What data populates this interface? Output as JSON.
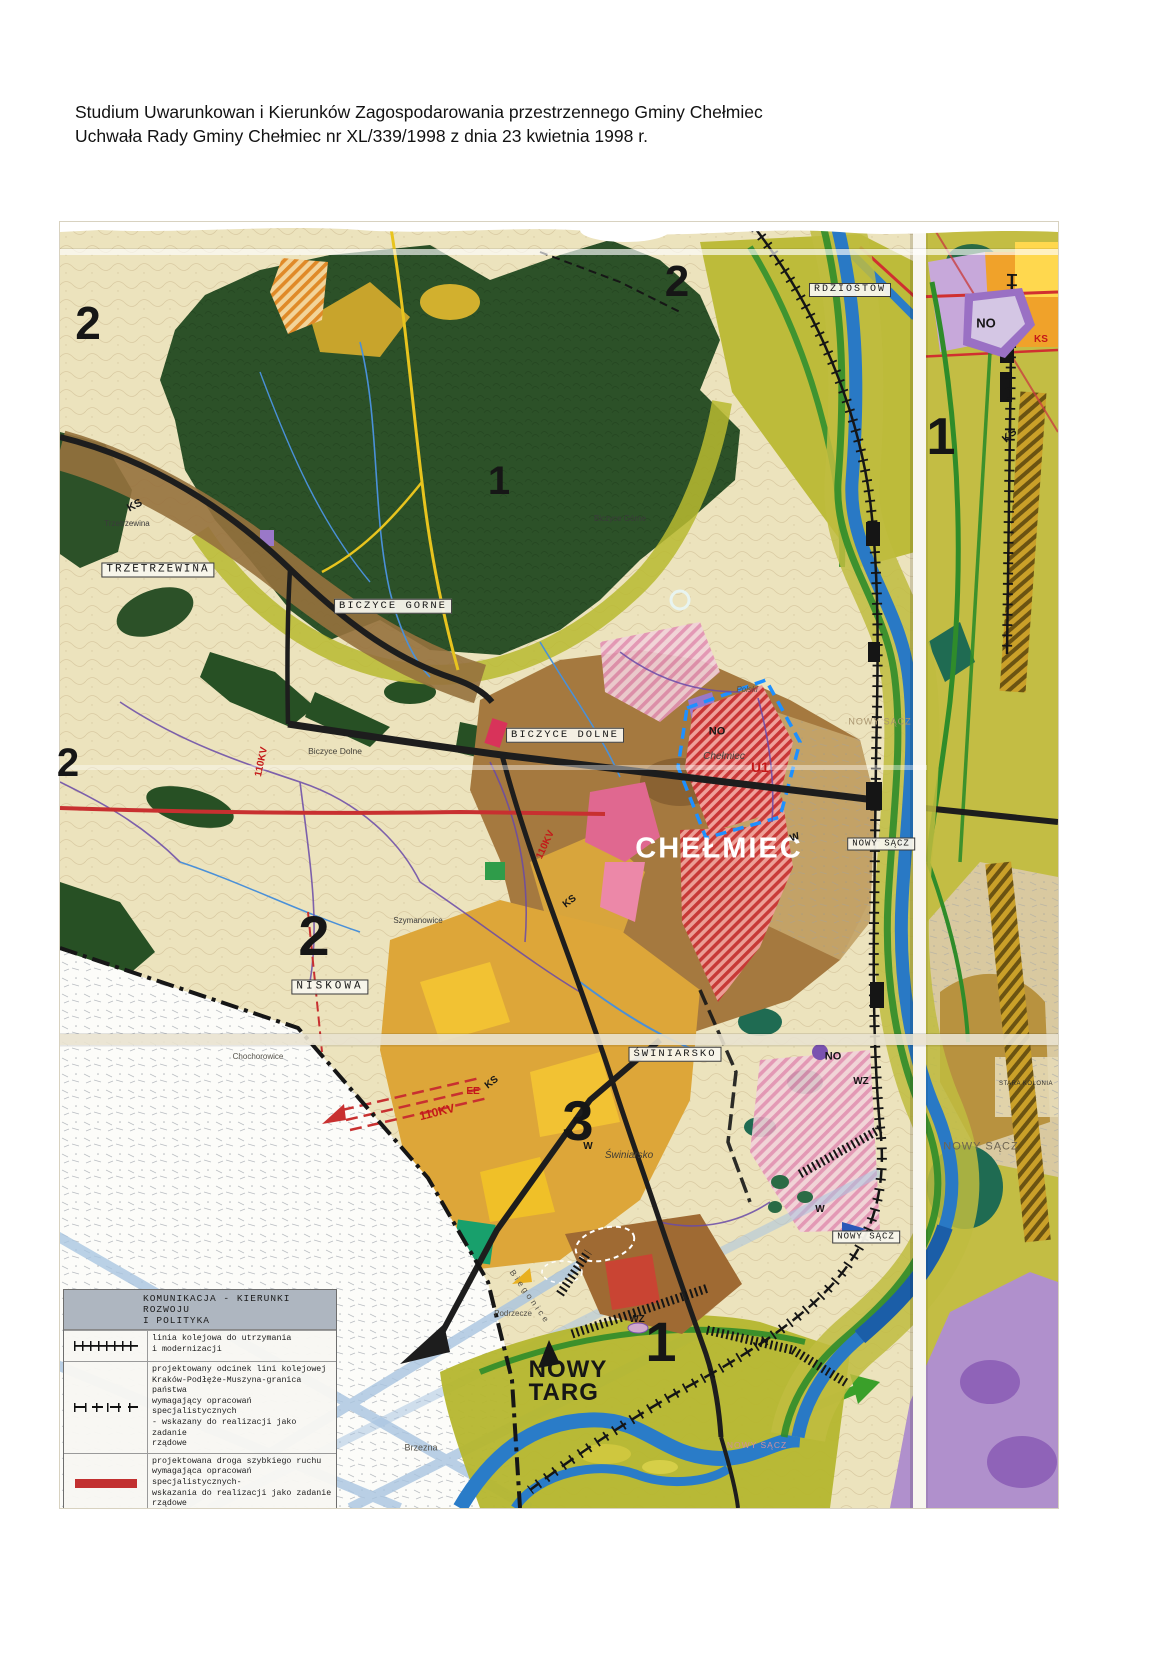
{
  "header": {
    "line1": "Studium Uwarunkowan i Kierunków Zagospodarowania przestrzennego Gminy Chełmiec",
    "line2": "Uchwała Rady Gminy Chełmiec nr XL/339/1998 z dnia 23 kwietnia 1998 r."
  },
  "legend": {
    "title_line1": "KOMUNIKACJA - KIERUNKI ROZWOJU",
    "title_line2": "I POLITYKA",
    "items": [
      {
        "name": "railway-existing",
        "text": "linia kolejowa do utrzymania\ni modernizacji"
      },
      {
        "name": "railway-projected",
        "text": "projektowany odcinek lini kolejowej\nKraków-Podłęże-Muszyna-granica państwa\nwymagający opracowań specjalistycznych\n- wskazany do realizacji jako zadanie\nrządowe"
      },
      {
        "name": "expressway-projected",
        "text": "projektowana droga szybkiego  ruchu\nwymagająca opracowań specjalistycznych-\nwskazania do realizacji jako zadanie\nrządowe"
      },
      {
        "name": "national-roads",
        "text": "drogi krajowe wymagające modernizacji"
      },
      {
        "name": "national-roads-projected",
        "text": "projektowane odcinki dróg krajowych\no funkcji regionalnej wymagające\nopracowań specjalistycznych - wskazane\ndo realizacji jako zadanie rządowe"
      }
    ]
  },
  "palette": {
    "forest_green": "#2c5128",
    "valley_olive": "#bdbb3a",
    "river_blue": "#2979c5",
    "urban_brown": "#a5793f",
    "zone_mustard": "#dda639",
    "accent_red": "#c41818",
    "purple_zone": "#9a70c4",
    "cream_base": "#ece3bd"
  },
  "map": {
    "labels": [
      {
        "id": "zone-2-top-left",
        "text": "2",
        "x": 88,
        "y": 323,
        "fs": 46,
        "fw": 700
      },
      {
        "id": "zone-2-top-center",
        "text": "2",
        "x": 677,
        "y": 282,
        "fs": 44,
        "fw": 700
      },
      {
        "id": "zone-1-forest",
        "text": "1",
        "x": 499,
        "y": 481,
        "fs": 40,
        "fw": 700
      },
      {
        "id": "zone-1-right-panel",
        "text": "1",
        "x": 941,
        "y": 437,
        "fs": 52,
        "fw": 700
      },
      {
        "id": "zone-2-left-edge",
        "text": "2",
        "x": 68,
        "y": 763,
        "fs": 40,
        "fw": 700
      },
      {
        "id": "zone-2-niskowa",
        "text": "2",
        "x": 314,
        "y": 936,
        "fs": 56,
        "fw": 700
      },
      {
        "id": "zone-3-swiniarsko",
        "text": "3",
        "x": 578,
        "y": 1121,
        "fs": 56,
        "fw": 700
      },
      {
        "id": "zone-1-bottom",
        "text": "1",
        "x": 661,
        "y": 1342,
        "fs": 56,
        "fw": 700
      },
      {
        "id": "label-rdziostow",
        "text": "RDZIOSTOW",
        "x": 850,
        "y": 290,
        "fs": 10,
        "ls": 2,
        "bg": 1,
        "ff": "mono"
      },
      {
        "id": "label-trzetrzewina-small",
        "text": "Trzetrzewina",
        "x": 127,
        "y": 524,
        "fs": 8,
        "color": "#3a3a3a"
      },
      {
        "id": "label-trzetrzewina",
        "text": "TRZETRZEWINA",
        "x": 158,
        "y": 570,
        "fs": 11,
        "ls": 2,
        "bg": 1,
        "ff": "mono"
      },
      {
        "id": "label-ks-northwest",
        "text": "KS",
        "x": 135,
        "y": 506,
        "fs": 11,
        "fw": 700,
        "rot": -28
      },
      {
        "id": "label-biczyce-gorne-small",
        "text": "Biczyce Górne",
        "x": 620,
        "y": 519,
        "fs": 8,
        "color": "#3a3a3a"
      },
      {
        "id": "label-biczyce-gorne",
        "text": "BICZYCE GORNE",
        "x": 393,
        "y": 606,
        "fs": 10.5,
        "ls": 2,
        "bg": 1,
        "ff": "mono"
      },
      {
        "id": "label-biczyce-dolne",
        "text": "BICZYCE DOLNE",
        "x": 565,
        "y": 735,
        "fs": 10.5,
        "ls": 2,
        "bg": 1,
        "ff": "mono"
      },
      {
        "id": "label-biczyce-dolne-small",
        "text": "Biczyce Dolne",
        "x": 335,
        "y": 751,
        "fs": 8.5,
        "color": "#44423a"
      },
      {
        "id": "label-110kv-west",
        "text": "110KV",
        "x": 262,
        "y": 762,
        "fs": 10,
        "fw": 700,
        "color": "#c41818",
        "rot": -78
      },
      {
        "id": "label-niskowa",
        "text": "NISKOWA",
        "x": 330,
        "y": 987,
        "fs": 11,
        "ls": 3,
        "bg": 1,
        "ff": "mono"
      },
      {
        "id": "label-szymanowice",
        "text": "Szymanowice",
        "x": 418,
        "y": 921,
        "fs": 8,
        "color": "#3a3a3a"
      },
      {
        "id": "label-chochorowice",
        "text": "Chochorowice",
        "x": 258,
        "y": 1057,
        "fs": 8,
        "color": "#55524a"
      },
      {
        "id": "label-no-chelmiec",
        "text": "NO",
        "x": 717,
        "y": 732,
        "fs": 11,
        "fw": 700
      },
      {
        "id": "label-chelmiec-small",
        "text": "Chełmiec",
        "x": 724,
        "y": 757,
        "fs": 10,
        "it": 1,
        "color": "#4a4540"
      },
      {
        "id": "label-polski-small",
        "text": "Polski",
        "x": 747,
        "y": 690,
        "fs": 8,
        "it": 1,
        "color": "#55504a"
      },
      {
        "id": "label-u1",
        "text": "U1",
        "x": 760,
        "y": 767,
        "fs": 14,
        "fw": 700,
        "color": "#c41818"
      },
      {
        "id": "label-chelmiec-city",
        "text": "CHEŁMIEC",
        "x": 719,
        "y": 849,
        "fs": 29,
        "fw": 700,
        "ls": 2,
        "color": "#ffffff"
      },
      {
        "id": "label-nowy-sacz-road",
        "text": "NOWY SĄCZ",
        "x": 881,
        "y": 844,
        "fs": 9,
        "ls": 1,
        "bg": 1,
        "ff": "mono"
      },
      {
        "id": "label-nowy-sacz-faint-east",
        "text": "NOWY SĄCZ",
        "x": 880,
        "y": 722,
        "fs": 9,
        "ls": 1,
        "color": "#a8946e"
      },
      {
        "id": "label-w-road-east",
        "text": "W",
        "x": 795,
        "y": 838,
        "fs": 10,
        "fw": 700,
        "rot": -20
      },
      {
        "id": "label-ks-center",
        "text": "KS",
        "x": 570,
        "y": 902,
        "fs": 10,
        "fw": 700,
        "rot": -38
      },
      {
        "id": "label-110kv-center",
        "text": "110KV",
        "x": 546,
        "y": 845,
        "fs": 10,
        "fw": 700,
        "color": "#c41818",
        "rot": -65
      },
      {
        "id": "label-no-right-panel",
        "text": "NO",
        "x": 986,
        "y": 323,
        "fs": 13,
        "fw": 700
      },
      {
        "id": "label-ks-right-red",
        "text": "KS",
        "x": 1041,
        "y": 340,
        "fs": 10,
        "fw": 700,
        "color": "#c41818"
      },
      {
        "id": "label-ks-right-black",
        "text": "KS",
        "x": 1010,
        "y": 436,
        "fs": 11,
        "fw": 700,
        "rot": -42
      },
      {
        "id": "label-swiniarsko",
        "text": "ŚWINIARSKO",
        "x": 675,
        "y": 1054,
        "fs": 10.5,
        "ls": 2,
        "bg": 1,
        "ff": "mono"
      },
      {
        "id": "label-no-valley",
        "text": "NO",
        "x": 833,
        "y": 1057,
        "fs": 11,
        "fw": 700
      },
      {
        "id": "label-wz-valley",
        "text": "WZ",
        "x": 861,
        "y": 1082,
        "fs": 10,
        "fw": 700
      },
      {
        "id": "label-stara-kolonia",
        "text": "STARA KOLONIA",
        "x": 1026,
        "y": 1084,
        "fs": 6,
        "ls": 0.5,
        "color": "#2a2a2a"
      },
      {
        "id": "label-nowy-sacz-right-panel",
        "text": "NOWY SĄCZ",
        "x": 981,
        "y": 1147,
        "fs": 11,
        "ls": 1,
        "color": "#6e6450"
      },
      {
        "id": "label-ks-swiniarsko",
        "text": "KS",
        "x": 492,
        "y": 1083,
        "fs": 10,
        "fw": 700,
        "rot": -38
      },
      {
        "id": "label-ee",
        "text": "EE",
        "x": 473,
        "y": 1092,
        "fs": 10,
        "fw": 700,
        "color": "#c41818"
      },
      {
        "id": "label-110kv-south",
        "text": "110KV",
        "x": 437,
        "y": 1112,
        "fs": 12,
        "fw": 700,
        "color": "#c41818",
        "rot": -14
      },
      {
        "id": "label-w-swiniarsko",
        "text": "W",
        "x": 588,
        "y": 1147,
        "fs": 10,
        "fw": 700
      },
      {
        "id": "label-swiniarsko-script",
        "text": "Świniarsko",
        "x": 629,
        "y": 1156,
        "fs": 10,
        "it": 1,
        "color": "#3f3b34"
      },
      {
        "id": "label-w-valley-south",
        "text": "W",
        "x": 820,
        "y": 1210,
        "fs": 10,
        "fw": 700
      },
      {
        "id": "label-nowy-sacz-arrow",
        "text": "NOWY SĄCZ",
        "x": 866,
        "y": 1237,
        "fs": 9,
        "ls": 1,
        "bg": 1,
        "ff": "mono"
      },
      {
        "id": "label-wz-bottom",
        "text": "WZ",
        "x": 637,
        "y": 1320,
        "fs": 10,
        "fw": 700
      },
      {
        "id": "label-podrzecze",
        "text": "Podrzecze",
        "x": 513,
        "y": 1314,
        "fs": 8,
        "color": "#55524a"
      },
      {
        "id": "label-biegonice",
        "text": "Biegonice",
        "x": 530,
        "y": 1297,
        "fs": 8.5,
        "ls": 3,
        "rot": 55,
        "color": "#55524a"
      },
      {
        "id": "label-nowy-targ",
        "text": "NOWY\nTARG",
        "x": 568,
        "y": 1382,
        "fs": 24,
        "fw": 700,
        "ls": 1,
        "pre": 1
      },
      {
        "id": "label-brzezna",
        "text": "Brzezna",
        "x": 421,
        "y": 1448,
        "fs": 9,
        "color": "#55524a"
      },
      {
        "id": "label-nowy-sacz-bottom",
        "text": "NOWY SĄCZ",
        "x": 757,
        "y": 1445,
        "fs": 8.5,
        "ls": 1,
        "color": "#cf8f9f"
      }
    ]
  }
}
